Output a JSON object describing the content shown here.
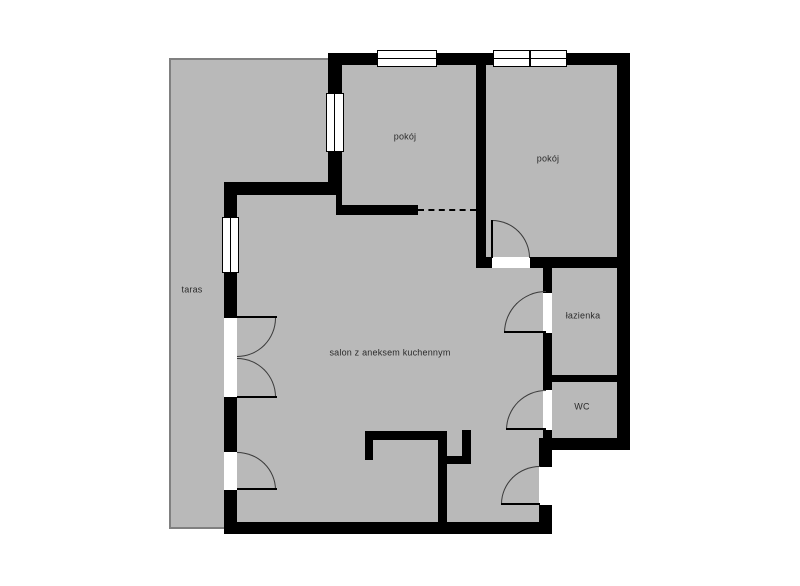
{
  "rooms": {
    "taras": {
      "label": "taras"
    },
    "pokoj1": {
      "label": "pokój"
    },
    "pokoj2": {
      "label": "pokój"
    },
    "salon": {
      "label": "salon z aneksem kuchennym"
    },
    "lazienka": {
      "label": "łazienka"
    },
    "wc": {
      "label": "WC"
    }
  },
  "colors": {
    "background": "#ffffff",
    "floor": "#b9b9b9",
    "wall": "#000000",
    "terrace_outline": "#808080",
    "door_arc": "#3a3a3a",
    "label": "#2b2b2b"
  }
}
